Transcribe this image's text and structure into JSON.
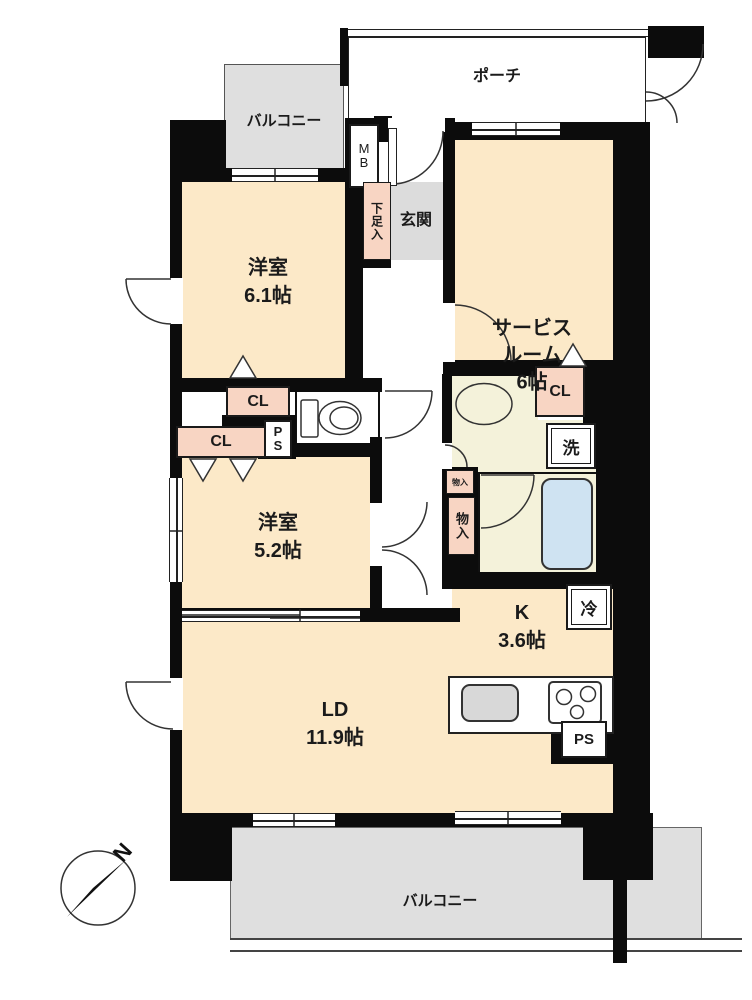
{
  "floorplan": {
    "compass": "N",
    "porch": "ポーチ",
    "balcony_top": "バルコニー",
    "balcony_bottom": "バルコニー",
    "meter_box": "MB",
    "entrance": "玄関",
    "shoe_cabinet": "下足入",
    "service_room": {
      "name_line1": "サービス",
      "name_line2": "ルーム",
      "size": "6帖"
    },
    "bedroom1": {
      "name": "洋室",
      "size": "6.1帖"
    },
    "bedroom2": {
      "name": "洋室",
      "size": "5.2帖"
    },
    "living_dining": {
      "name": "LD",
      "size": "11.9帖"
    },
    "kitchen": {
      "name": "K",
      "size": "3.6帖"
    },
    "closet1": "CL",
    "closet2": "CL",
    "closet3": "CL",
    "pipe_space1": "PS",
    "pipe_space2": "PS",
    "laundry": "洗",
    "refrigerator": "冷",
    "storage_small": "物入",
    "storage": "物入",
    "colors": {
      "room_floor": "#fce9c8",
      "closet": "#f8d5c3",
      "wet_floor": "#f4f2da",
      "bathtub": "#cfe3f2",
      "balcony": "#dfdfdf",
      "entrance_floor": "#dcdcdc",
      "wall": "#0c0c0c"
    }
  }
}
